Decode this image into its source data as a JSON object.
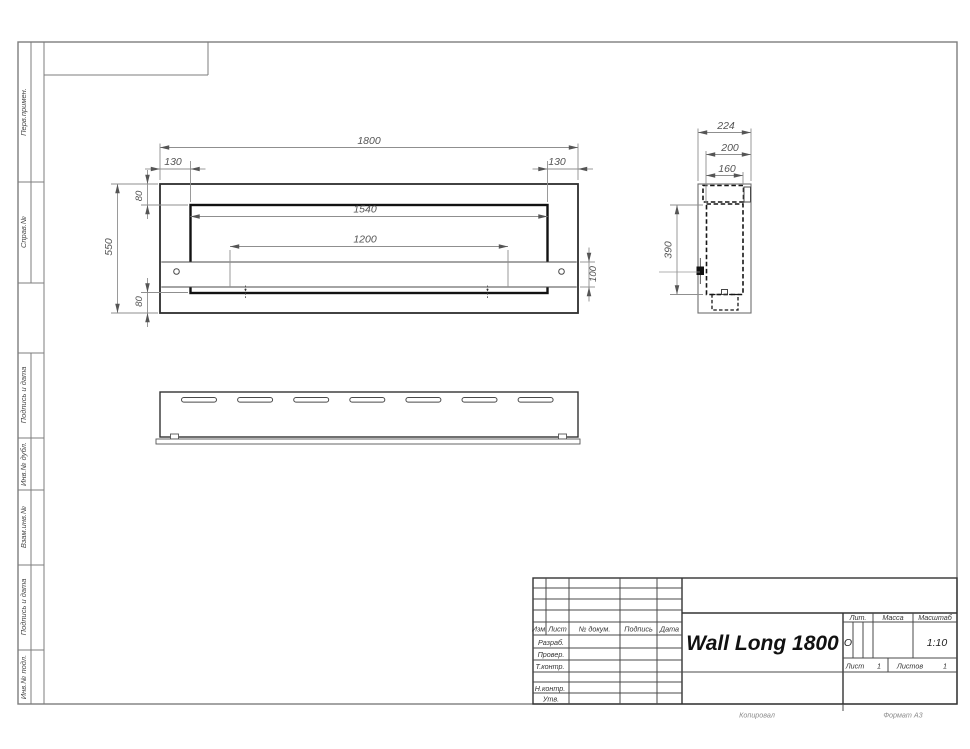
{
  "sheet": {
    "margin_labels": [
      {
        "label": "Перв.примен."
      },
      {
        "label": "Справ.№"
      },
      {
        "label": "Подпись и дата"
      },
      {
        "label": "Инв.№ дубл."
      },
      {
        "label": "Взам.инв.№"
      },
      {
        "label": "Подпись и дата"
      },
      {
        "label": "Инв.№ подл."
      }
    ],
    "footer": {
      "copied_label": "Копировал",
      "format_label": "Формат А3"
    }
  },
  "views": {
    "front": {
      "dims": {
        "overall_width": "1800",
        "left_inset": "130",
        "right_inset": "130",
        "top_flange": "80",
        "overall_height": "550",
        "bottom_flange": "80",
        "opening_width": "1540",
        "bracket_span": "1200",
        "bracket_height": "100"
      }
    },
    "side": {
      "dims": {
        "overall_depth": "224",
        "inner_depth": "200",
        "opening_depth": "160",
        "inner_height": "390"
      }
    }
  },
  "title_block": {
    "title": "Wall Long 1800",
    "columns": {
      "izm": "Изм.",
      "list": "Лист",
      "doc": "№ докум.",
      "sign": "Подпись",
      "date": "Дата"
    },
    "rows": {
      "razrab": "Разраб.",
      "prover": "Провер.",
      "tkontr": "Т.контр.",
      "nkontr": "Н.контр.",
      "utv": "Утв."
    },
    "lit": {
      "label": "Лит.",
      "value": "О"
    },
    "mass": {
      "label": "Масса"
    },
    "scale": {
      "label": "Масштаб",
      "value": "1:10"
    },
    "sheet_no": {
      "label": "Лист",
      "value": "1"
    },
    "sheets_total": {
      "label": "Листов",
      "value": "1"
    }
  }
}
